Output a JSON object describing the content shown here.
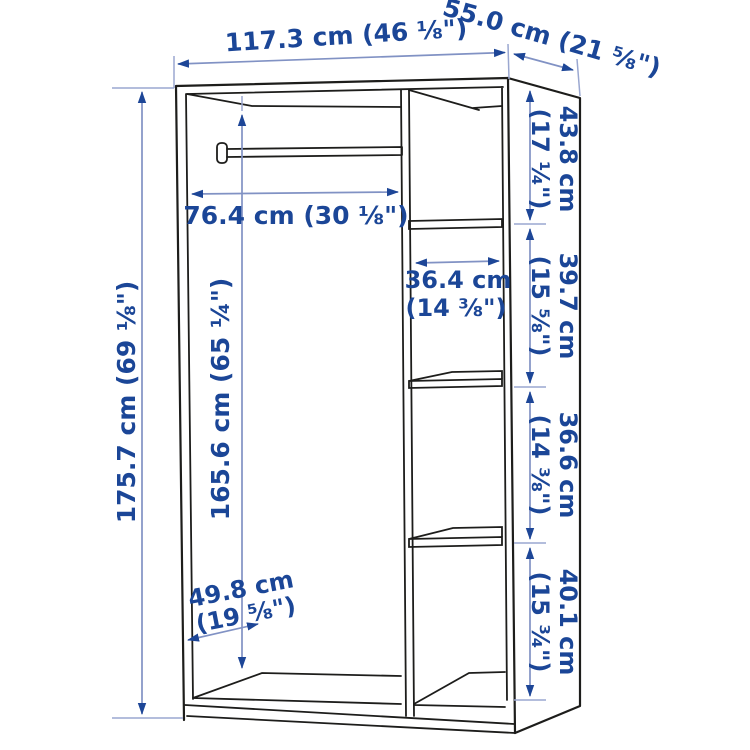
{
  "diagram": {
    "title": "wardrobe-dimension-diagram",
    "colors": {
      "outline": "#1d1d1b",
      "dimension_line": "#8192c4",
      "dimension_text": "#1b4697",
      "background": "#ffffff"
    },
    "labels": {
      "width_top": "117.3 cm (46 ⅛\")",
      "depth_top": "55.0 cm (21 ⅝\")",
      "height_left": "175.7 cm (69 ⅛\")",
      "interior_height": "165.6 cm (65 ¼\")",
      "rail_width": "76.4 cm (30 ⅛\")",
      "shelf_width": {
        "cm": "36.4 cm",
        "inches": "(14 ⅜\")"
      },
      "interior_depth": {
        "cm": "49.8 cm",
        "inches": "(19 ⅝\")"
      },
      "right_sections": [
        {
          "cm": "43.8 cm",
          "inches": "(17 ¼\")"
        },
        {
          "cm": "39.7 cm",
          "inches": "(15 ⅝\")"
        },
        {
          "cm": "36.6 cm",
          "inches": "(14 ⅜\")"
        },
        {
          "cm": "40.1 cm",
          "inches": "(15 ¾\")"
        }
      ]
    }
  }
}
